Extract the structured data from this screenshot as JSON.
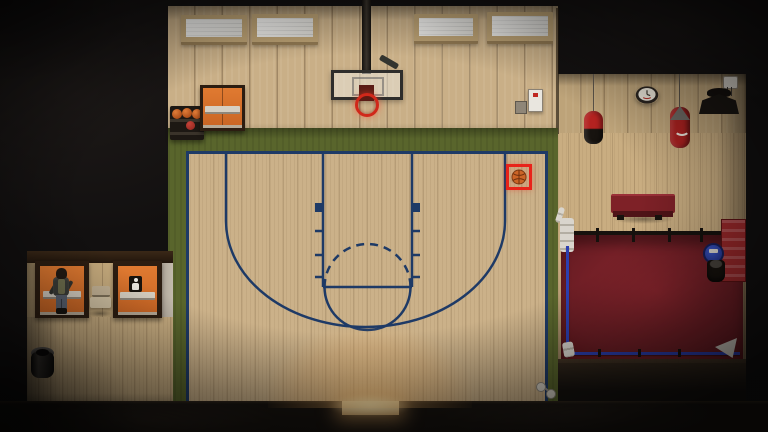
{
  "scene": {
    "game_view": "top-down gym interior",
    "areas": [
      "basketball half-court",
      "boxing ring corner",
      "hallway with doors"
    ],
    "window_count": 4,
    "rack_ball_count": 4
  },
  "labels": {
    "player": "Player character",
    "pickup": "Basketball (highlighted pickup)",
    "door_exit": "Gym exit door",
    "door_locker": "Hallway door",
    "door_restroom": "Restroom door",
    "ring": "Boxing ring",
    "bag_heavy": "Punching bag",
    "bag_striped": "Punching bag",
    "hoop": "Basketball hoop"
  },
  "icons": {
    "restroom_sign": "person-icon",
    "pickup_highlight": "red-selection-frame",
    "wall_clock": "clock-icon"
  },
  "theme": {
    "colors": {
      "voidBg": "#121010",
      "wallWood": "#c9af87",
      "wallWoodRight": "#bda379",
      "floorCourt": "#cbb189",
      "floorRight": "#c9ad81",
      "floorHall": "#c9ae82",
      "green": "#59652c",
      "courtLine": "#1e3a66",
      "doorOrange": "#dd762e",
      "doorFrame": "#2c1d11",
      "highlightRed": "#e8231a",
      "basketball": "#cc6427",
      "rimRed": "#d0281a",
      "ringMat": "#7a2128",
      "ropeBlue": "#2c3fb0",
      "ringCornerRed": "#a02a2c",
      "benchRed": "#7e2127",
      "bagRed": "#ab2120",
      "stoolBlue": "#2f4cc0",
      "glowWarm": "#ffc87e",
      "clockFace": "#ebe6da",
      "windowPane": "#d8d6d0",
      "windowFrame": "#b99f72",
      "signBlack": "#17120d",
      "trimGray": "#b5aca0"
    }
  }
}
